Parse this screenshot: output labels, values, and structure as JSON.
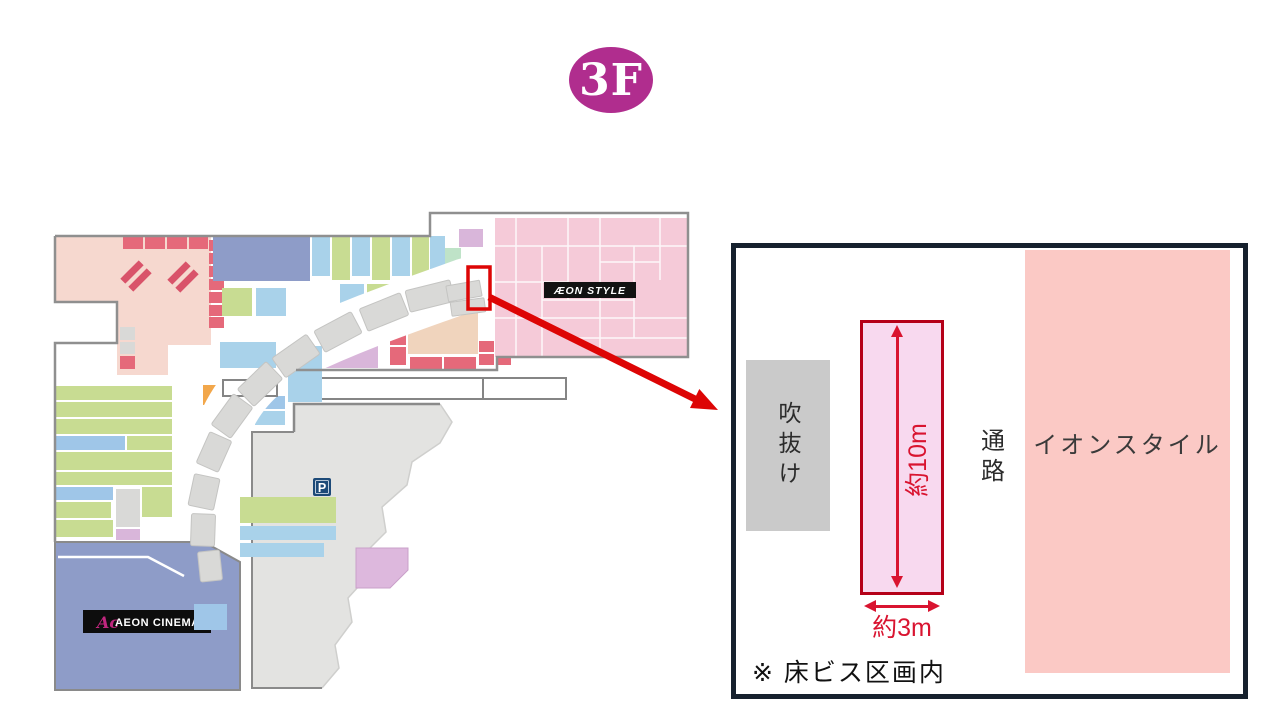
{
  "floor_badge": {
    "label": "3F",
    "color": "#b02d8e"
  },
  "map": {
    "aeon_style_label": "ÆON STYLE",
    "aeon_cinema_logo": "Ac",
    "aeon_cinema_label": "AEON CINEMA",
    "parking_label": "P"
  },
  "detail_panel": {
    "atrium_label": "吹抜け",
    "corridor_label": "通路",
    "store_label": "イオンスタイル",
    "depth_label": "約10m",
    "width_label": "約3m",
    "note": "※ 床ビス区画内"
  },
  "colors": {
    "badge": "#b02d8e",
    "annotation_red": "#dd0505",
    "dimension_red": "#d91430",
    "target_fill": "#f8d9ef",
    "target_border": "#b50018",
    "store_fill": "#fbc9c5",
    "atrium_fill": "#cacaca",
    "panel_border": "#16212e",
    "aeon_style_pink": "#f5cad8",
    "cinema_blue": "#8e9cc8",
    "parking_gray": "#e3e3e1"
  }
}
